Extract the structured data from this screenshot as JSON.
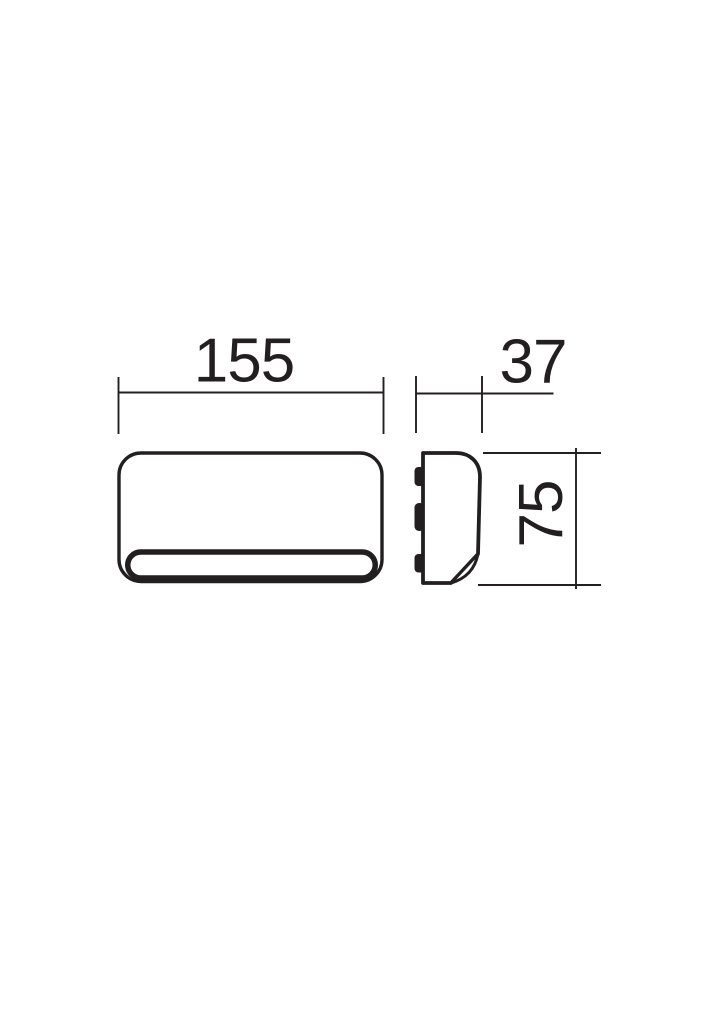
{
  "diagram": {
    "type": "technical-dimension-drawing",
    "subject": "wall-light-fixture-front-and-side-views",
    "colors": {
      "ink": "#231f20",
      "background": "#ffffff"
    },
    "dimensions": [
      {
        "id": "front-width",
        "value": "155",
        "orientation": "horizontal"
      },
      {
        "id": "side-depth",
        "value": "37",
        "orientation": "horizontal"
      },
      {
        "id": "side-height",
        "value": "75",
        "orientation": "vertical"
      }
    ]
  }
}
